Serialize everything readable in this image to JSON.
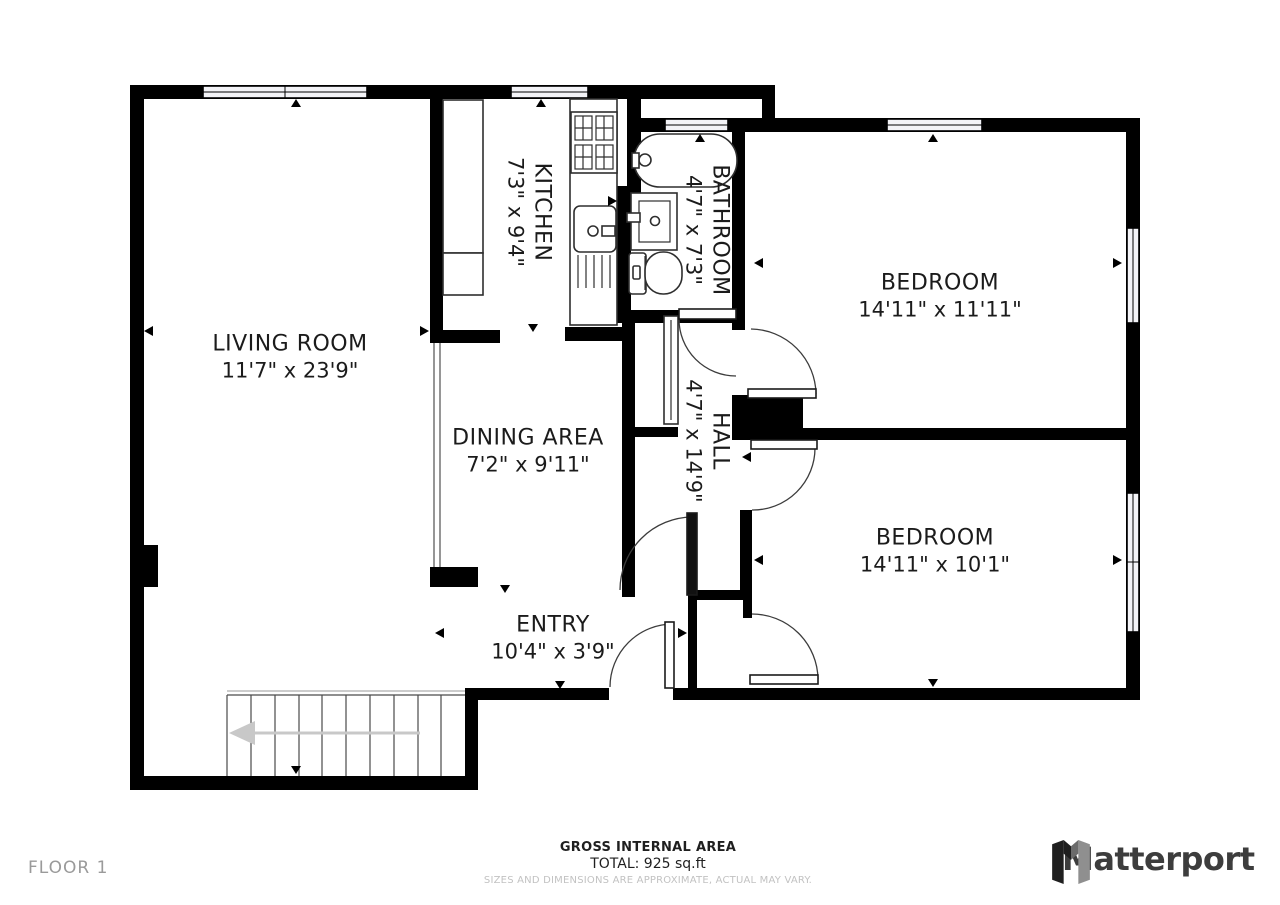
{
  "rooms": {
    "living_room": {
      "name": "LIVING ROOM",
      "dims": "11'7\" x 23'9\""
    },
    "kitchen": {
      "name": "KITCHEN",
      "dims": "7'3\" x 9'4\""
    },
    "bathroom": {
      "name": "BATHROOM",
      "dims": "4'7\" x 7'3\""
    },
    "bedroom_top": {
      "name": "BEDROOM",
      "dims": "14'11\" x 11'11\""
    },
    "dining_area": {
      "name": "DINING AREA",
      "dims": "7'2\" x 9'11\""
    },
    "hall": {
      "name": "HALL",
      "dims": "4'7\" x 14'9\""
    },
    "bedroom_bottom": {
      "name": "BEDROOM",
      "dims": "14'11\" x 10'1\""
    },
    "entry": {
      "name": "ENTRY",
      "dims": "10'4\" x 3'9\""
    }
  },
  "footer": {
    "floor_label": "FLOOR 1",
    "area_title": "GROSS INTERNAL AREA",
    "area_total": "TOTAL: 925 sq.ft",
    "disclaimer": "SIZES AND DIMENSIONS ARE APPROXIMATE, ACTUAL MAY VARY.",
    "brand": "Matterport"
  },
  "colors": {
    "wall": "#000000",
    "background": "#ffffff",
    "muted_text": "#9a9a9a",
    "disclaimer_text": "#c2c2c2",
    "brand_text": "#3d3d3d",
    "stairs_arrow": "#c8c8c8"
  }
}
